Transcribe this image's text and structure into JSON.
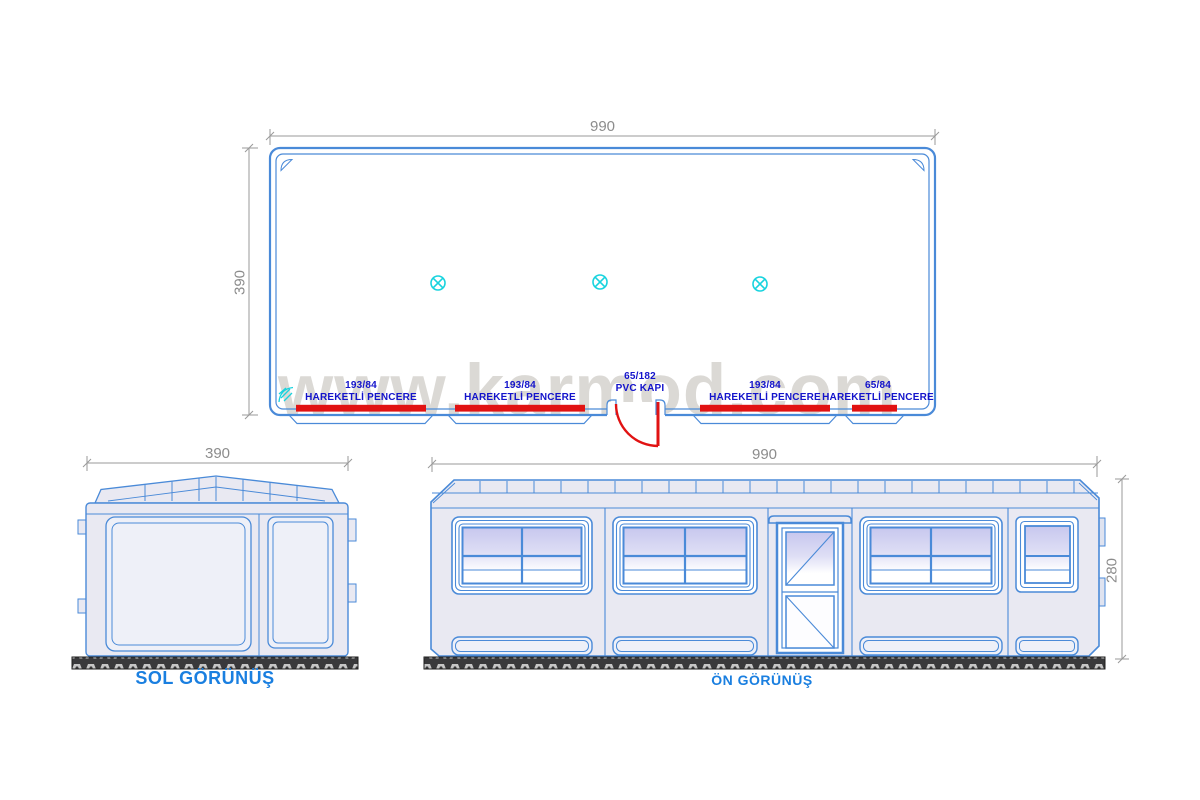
{
  "watermark": "www.karmod.com",
  "plan_view": {
    "width_dim": "990",
    "depth_dim": "390",
    "openings": [
      {
        "size": "193/84",
        "label": "HAREKETLİ PENCERE"
      },
      {
        "size": "193/84",
        "label": "HAREKETLİ PENCERE"
      },
      {
        "size": "65/182",
        "label": "PVC KAPI"
      },
      {
        "size": "193/84",
        "label": "HAREKETLİ PENCERE"
      },
      {
        "size": "65/84",
        "label": "HAREKETLİ PENCERE"
      }
    ]
  },
  "left_view": {
    "title": "SOL GÖRÜNÜŞ",
    "width_dim": "390"
  },
  "front_view": {
    "title": "ÖN GÖRÜNÜŞ",
    "width_dim": "990",
    "height_dim": "280"
  },
  "colors": {
    "drawing_blue": "#4a8ad8",
    "opening_red": "#e11212",
    "lamp_cyan": "#17d3de",
    "label_navy": "#1313cb",
    "title_blue": "#1a7fe0",
    "dim_gray": "#8c8c8c",
    "body_fill": "#e9e9f2",
    "glass_top": "#c7c7ee"
  }
}
